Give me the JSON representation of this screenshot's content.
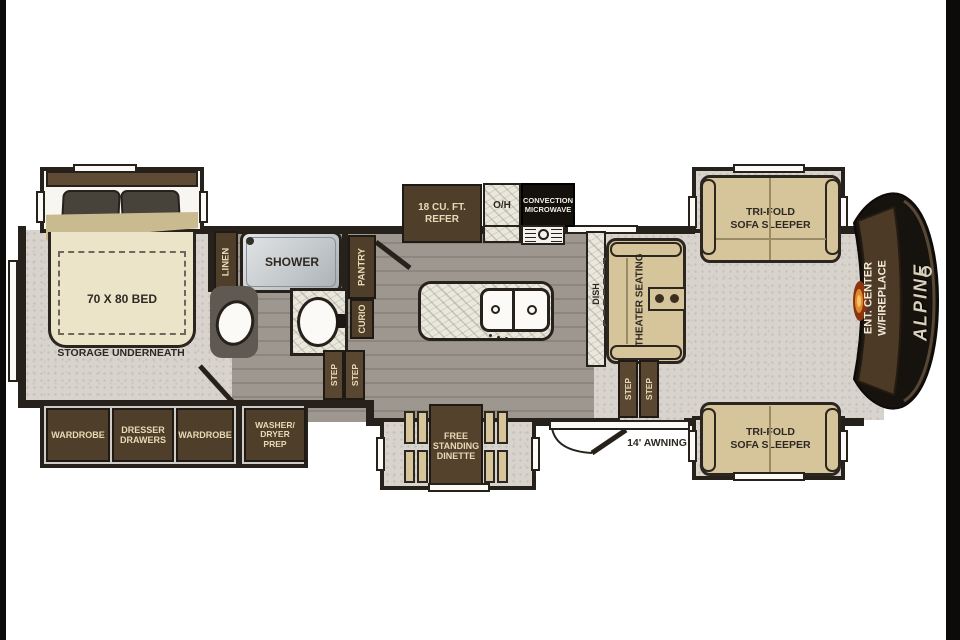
{
  "palette": {
    "wall": "#26211a",
    "cabinet_brown": "#4f3e29",
    "cabinet_text": "#e8dab6",
    "furniture_tan": "#d6c59a",
    "bed_cream": "#ece4c8",
    "carpet": "#d8d4cd",
    "wood_floor": "#9a938b",
    "counter_marble": "#eae7dc",
    "rear_cap_black": "#16120d",
    "rear_cap_brown": "#4c3a26",
    "fireplace_glow": "#e08a2e",
    "label_dark": "#2e2922"
  },
  "plan": {
    "bedroom": {
      "bed": "70 X 80 BED",
      "storage": "STORAGE UNDERNEATH"
    },
    "bath": {
      "linen": "LINEN",
      "shower": "SHOWER",
      "pantry": "PANTRY",
      "curio": "CURIO"
    },
    "step": "STEP",
    "kitchen": {
      "refer": [
        "18 CU. FT.",
        "REFER"
      ],
      "overhead": "O/H",
      "microwave": [
        "CONVECTION",
        "MICROWAVE"
      ],
      "dish": "DISH",
      "washer": "WASHER"
    },
    "living": {
      "theater": "THEATER SEATING",
      "sofa": [
        "TRI-FOLD",
        "SOFA SLEEPER"
      ]
    },
    "rear": {
      "ent_center": [
        "ENT. CENTER",
        "W/FIREPLACE"
      ],
      "brand": "ALPINE"
    },
    "slideout": {
      "wardrobe": "WARDROBE",
      "dresser": [
        "DRESSER",
        "DRAWERS"
      ],
      "washer_dryer": [
        "WASHER/",
        "DRYER",
        "PREP"
      ]
    },
    "dinette": [
      "FREE",
      "STANDING",
      "DINETTE"
    ],
    "exterior": {
      "awning": "14' AWNING"
    }
  }
}
